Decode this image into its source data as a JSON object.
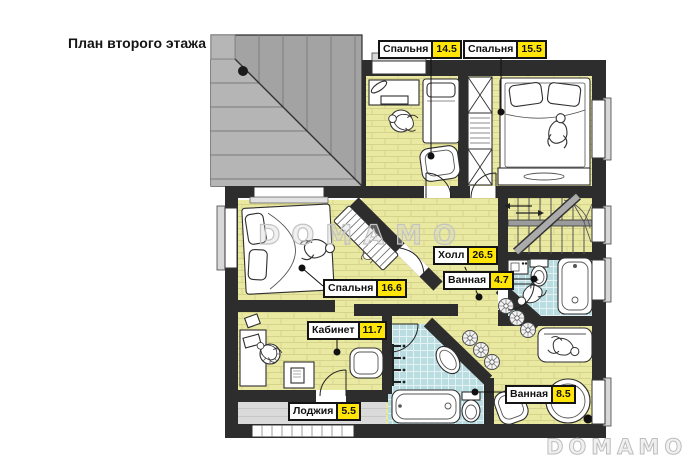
{
  "page": {
    "title": "План второго этажа"
  },
  "watermarks": {
    "center": "DOMAMO",
    "corner": "DOMAMO"
  },
  "labels": [
    {
      "name": "Спальня",
      "area": "14.5"
    },
    {
      "name": "Спальня",
      "area": "15.5"
    },
    {
      "name": "Холл",
      "area": "26.5"
    },
    {
      "name": "Ванная",
      "area": "4.7"
    },
    {
      "name": "Спальня",
      "area": "16.6"
    },
    {
      "name": "Кабинет",
      "area": "11.7"
    },
    {
      "name": "Лоджия",
      "area": "5.5"
    },
    {
      "name": "Ванная",
      "area": "8.5"
    }
  ],
  "colors": {
    "area_badge": "#ffe608",
    "floor_yellow": "#eae9a2",
    "floor_brick_line": "#d5d38c",
    "tile_blue": "#b9dde0",
    "wall": "#2d2d2d",
    "roof_light": "#b5b5b5",
    "roof_dark": "#a3a3a3",
    "loggia_floor": "#dadada",
    "watermark": "#c3c3c3"
  }
}
